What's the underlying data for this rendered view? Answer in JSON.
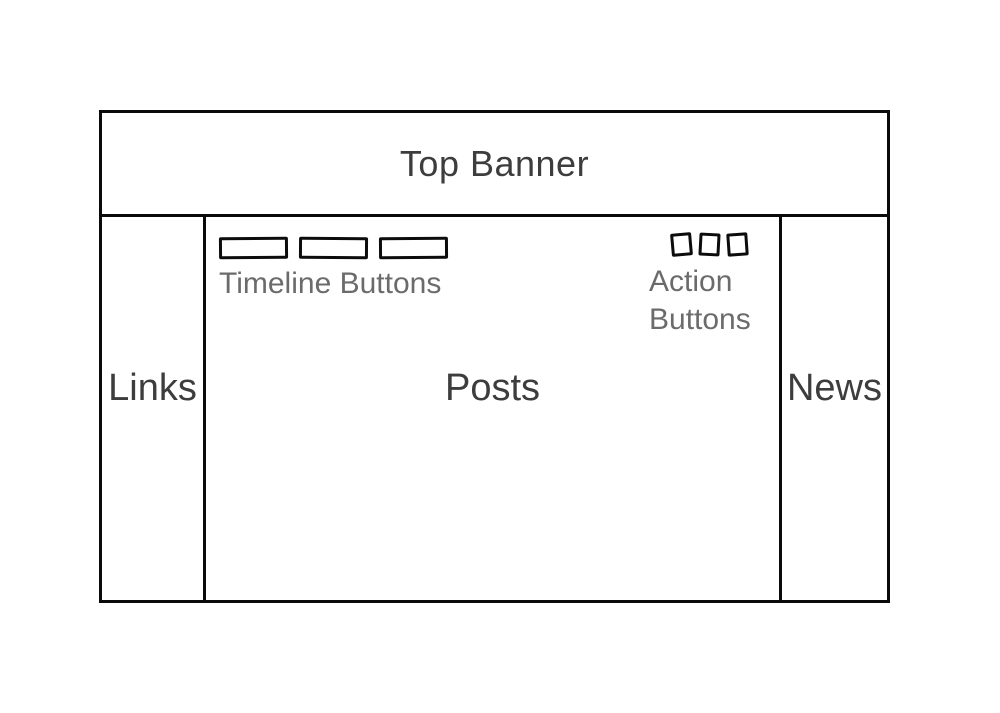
{
  "diagram": {
    "kind": "website-layout-wireframe",
    "banner": {
      "label": "Top Banner"
    },
    "left_sidebar": {
      "label": "Links"
    },
    "main": {
      "label": "Posts",
      "timeline": {
        "label": "Timeline Buttons",
        "button_count": 3
      },
      "actions": {
        "label_line1": "Action",
        "label_line2": "Buttons",
        "button_count": 3
      }
    },
    "right_sidebar": {
      "label": "News"
    }
  },
  "colors": {
    "background": "#ffffff",
    "line": "#0a0a0a",
    "label_dark": "#3d3d3d",
    "label_gray": "#6b6b6b"
  }
}
